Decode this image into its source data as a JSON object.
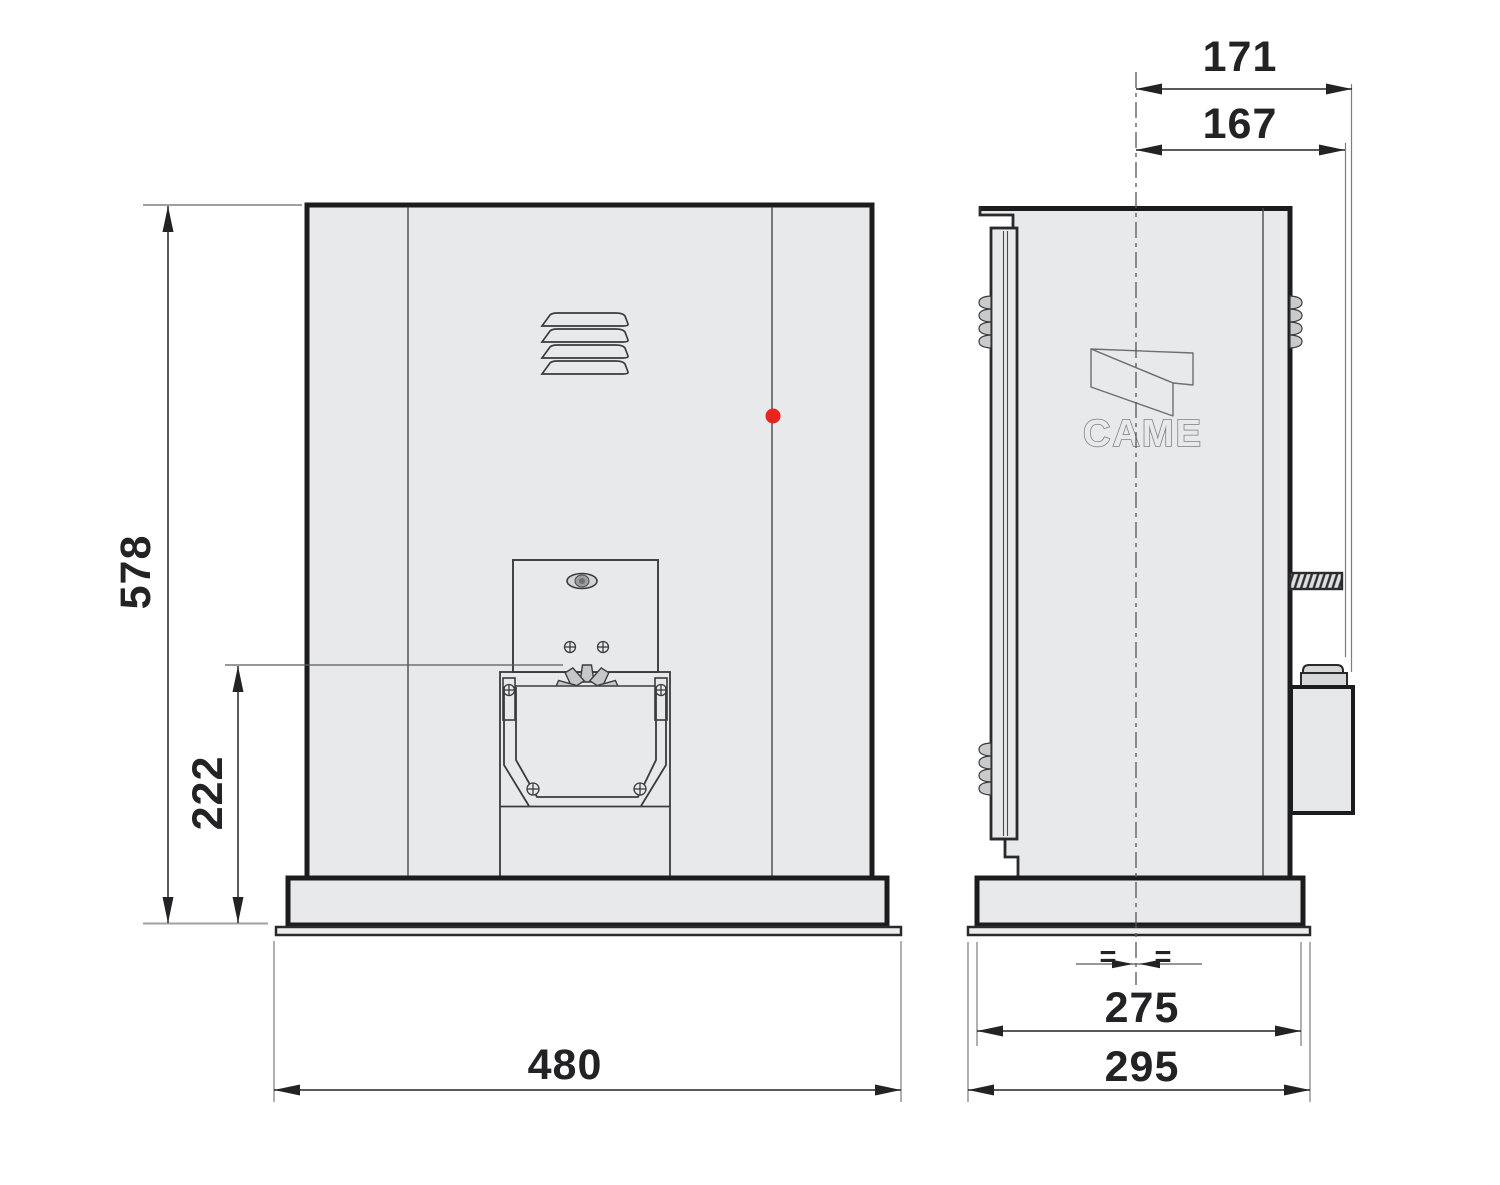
{
  "dimensions": {
    "front_overall_height": "578",
    "front_pinion_height": "222",
    "front_overall_width": "480",
    "side_depth_to_release_box": "171",
    "side_depth_to_release_knob": "167",
    "side_base_width": "275",
    "side_baseplate_width": "295"
  },
  "logo": {
    "brand": "CAME"
  },
  "symbols": {
    "equal_spacing": "="
  },
  "colors": {
    "indicator_red": "#e8241e",
    "line_dark": "#1c1c1e",
    "panel_fill": "#e8e9ea"
  }
}
